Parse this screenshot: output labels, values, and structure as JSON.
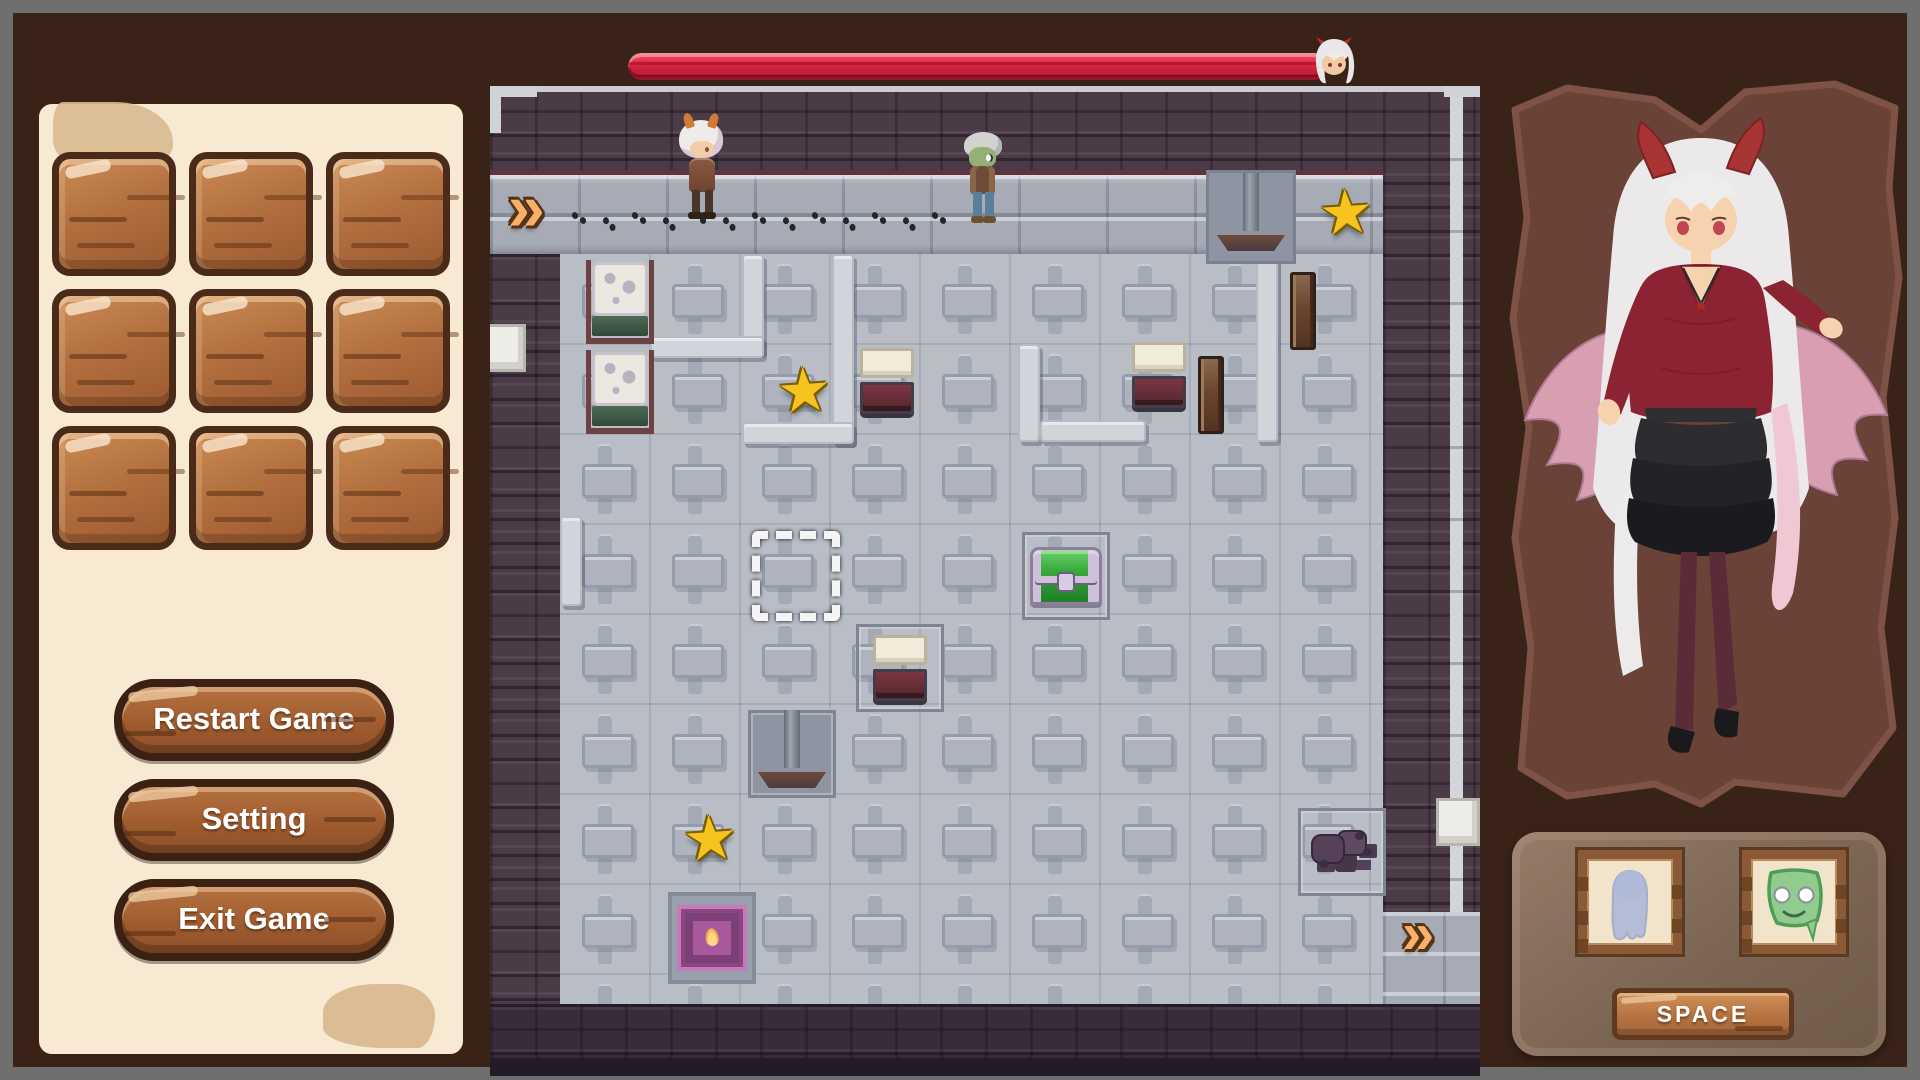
{
  "left_panel": {
    "slots": 9,
    "buttons": [
      {
        "id": "restart",
        "label": "Restart Game"
      },
      {
        "id": "setting",
        "label": "Setting"
      },
      {
        "id": "exit",
        "label": "Exit Game"
      }
    ]
  },
  "hud": {
    "health_percent": 100,
    "health_color": "#d92b44",
    "portrait": "demon-girl-face"
  },
  "game_map": {
    "tile_size": 90,
    "walls": [
      {
        "name": "top-wall",
        "x": 0,
        "y": 0,
        "w": 990,
        "h": 84,
        "style": ""
      },
      {
        "name": "left-wall",
        "x": 0,
        "y": 168,
        "w": 70,
        "h": 752,
        "style": ""
      },
      {
        "name": "right-wall",
        "x": 893,
        "y": 0,
        "w": 97,
        "h": 826,
        "style": ""
      },
      {
        "name": "inner-wall",
        "x": 455,
        "y": 168,
        "w": 290,
        "h": 90,
        "style": "wall--inner"
      },
      {
        "name": "bottom-wall",
        "x": 0,
        "y": 918,
        "w": 990,
        "h": 72,
        "style": "wall--bottom"
      },
      {
        "name": "bottom-edge",
        "x": 0,
        "y": 972,
        "w": 990,
        "h": 18,
        "style": "wall--edge"
      }
    ],
    "ridges": [
      {
        "x": 252,
        "y": 168,
        "w": 22,
        "h": 100
      },
      {
        "x": 160,
        "y": 250,
        "w": 114,
        "h": 22
      },
      {
        "x": 342,
        "y": 168,
        "w": 22,
        "h": 190
      },
      {
        "x": 252,
        "y": 336,
        "w": 112,
        "h": 22
      },
      {
        "x": 528,
        "y": 258,
        "w": 22,
        "h": 98
      },
      {
        "x": 550,
        "y": 334,
        "w": 106,
        "h": 22
      },
      {
        "x": 766,
        "y": 168,
        "w": 22,
        "h": 188
      },
      {
        "x": 70,
        "y": 430,
        "w": 22,
        "h": 90
      }
    ],
    "footprints": {
      "x_start": 82,
      "y": 126,
      "step": 30,
      "count": 13
    },
    "objects": [
      {
        "type": "arrow",
        "name": "entry-arrow",
        "x": 18,
        "y": 92,
        "size": 66,
        "interactable": true
      },
      {
        "type": "player",
        "name": "player-character",
        "x": 186,
        "y": 34
      },
      {
        "type": "zombie",
        "name": "zombie-enemy",
        "x": 470,
        "y": 46
      },
      {
        "type": "press",
        "name": "press-trap",
        "x": 716,
        "y": 84
      },
      {
        "type": "star",
        "name": "star-pickup",
        "x": 828,
        "y": 98
      },
      {
        "type": "marble",
        "name": "marble-block",
        "x": 96,
        "y": 174
      },
      {
        "type": "marble",
        "name": "marble-block",
        "x": 96,
        "y": 264
      },
      {
        "type": "star",
        "name": "star-pickup",
        "x": 286,
        "y": 276
      },
      {
        "type": "pressure",
        "name": "pressure-box",
        "x": 370,
        "y": 262
      },
      {
        "type": "pressure",
        "name": "pressure-box",
        "x": 642,
        "y": 256
      },
      {
        "type": "rust",
        "name": "metal-wall-panel",
        "x": 800,
        "y": 186
      },
      {
        "type": "rust",
        "name": "metal-wall-panel",
        "x": 708,
        "y": 270
      },
      {
        "type": "cursor",
        "name": "selection-cursor",
        "x": 262,
        "y": 446,
        "interactable": true
      },
      {
        "type": "chest",
        "name": "treasure-chest",
        "x": 532,
        "y": 446,
        "pad": true,
        "interactable": true
      },
      {
        "type": "pressure",
        "name": "pressure-box",
        "x": 366,
        "y": 538,
        "pad": true
      },
      {
        "type": "press",
        "name": "press-trap",
        "x": 258,
        "y": 624,
        "pad": true
      },
      {
        "type": "star",
        "name": "star-pickup",
        "x": 192,
        "y": 724
      },
      {
        "type": "door",
        "name": "flame-door",
        "x": 178,
        "y": 806,
        "interactable": true
      },
      {
        "type": "rocks",
        "name": "rock-pile",
        "x": 808,
        "y": 722,
        "pad": true
      },
      {
        "type": "wblock",
        "name": "stone-block",
        "x": 946,
        "y": 712
      },
      {
        "type": "arrow",
        "name": "exit-arrow",
        "x": 912,
        "y": 822,
        "size": 58,
        "interactable": true
      },
      {
        "type": "wblock",
        "name": "stone-block",
        "x": -8,
        "y": 238
      }
    ]
  },
  "right_panel": {
    "character": "demon-girl",
    "dialog_portraits": [
      {
        "id": "ghost",
        "label": "ghost-figure"
      },
      {
        "id": "slime",
        "label": "green-slime-face"
      }
    ],
    "space_button_label": "SPACE"
  },
  "colors": {
    "background": "#392318",
    "frame": "#6f6f6f",
    "panel_cream": "#f8e9d2",
    "wood": "#a05c2f",
    "health_red": "#d92b44",
    "floor_gray": "#b9bdc5",
    "wall_purple": "#4b3b47",
    "star_gold": "#f5c41e",
    "chest_green": "#37a93c",
    "arrow_orange": "#f9b168"
  }
}
